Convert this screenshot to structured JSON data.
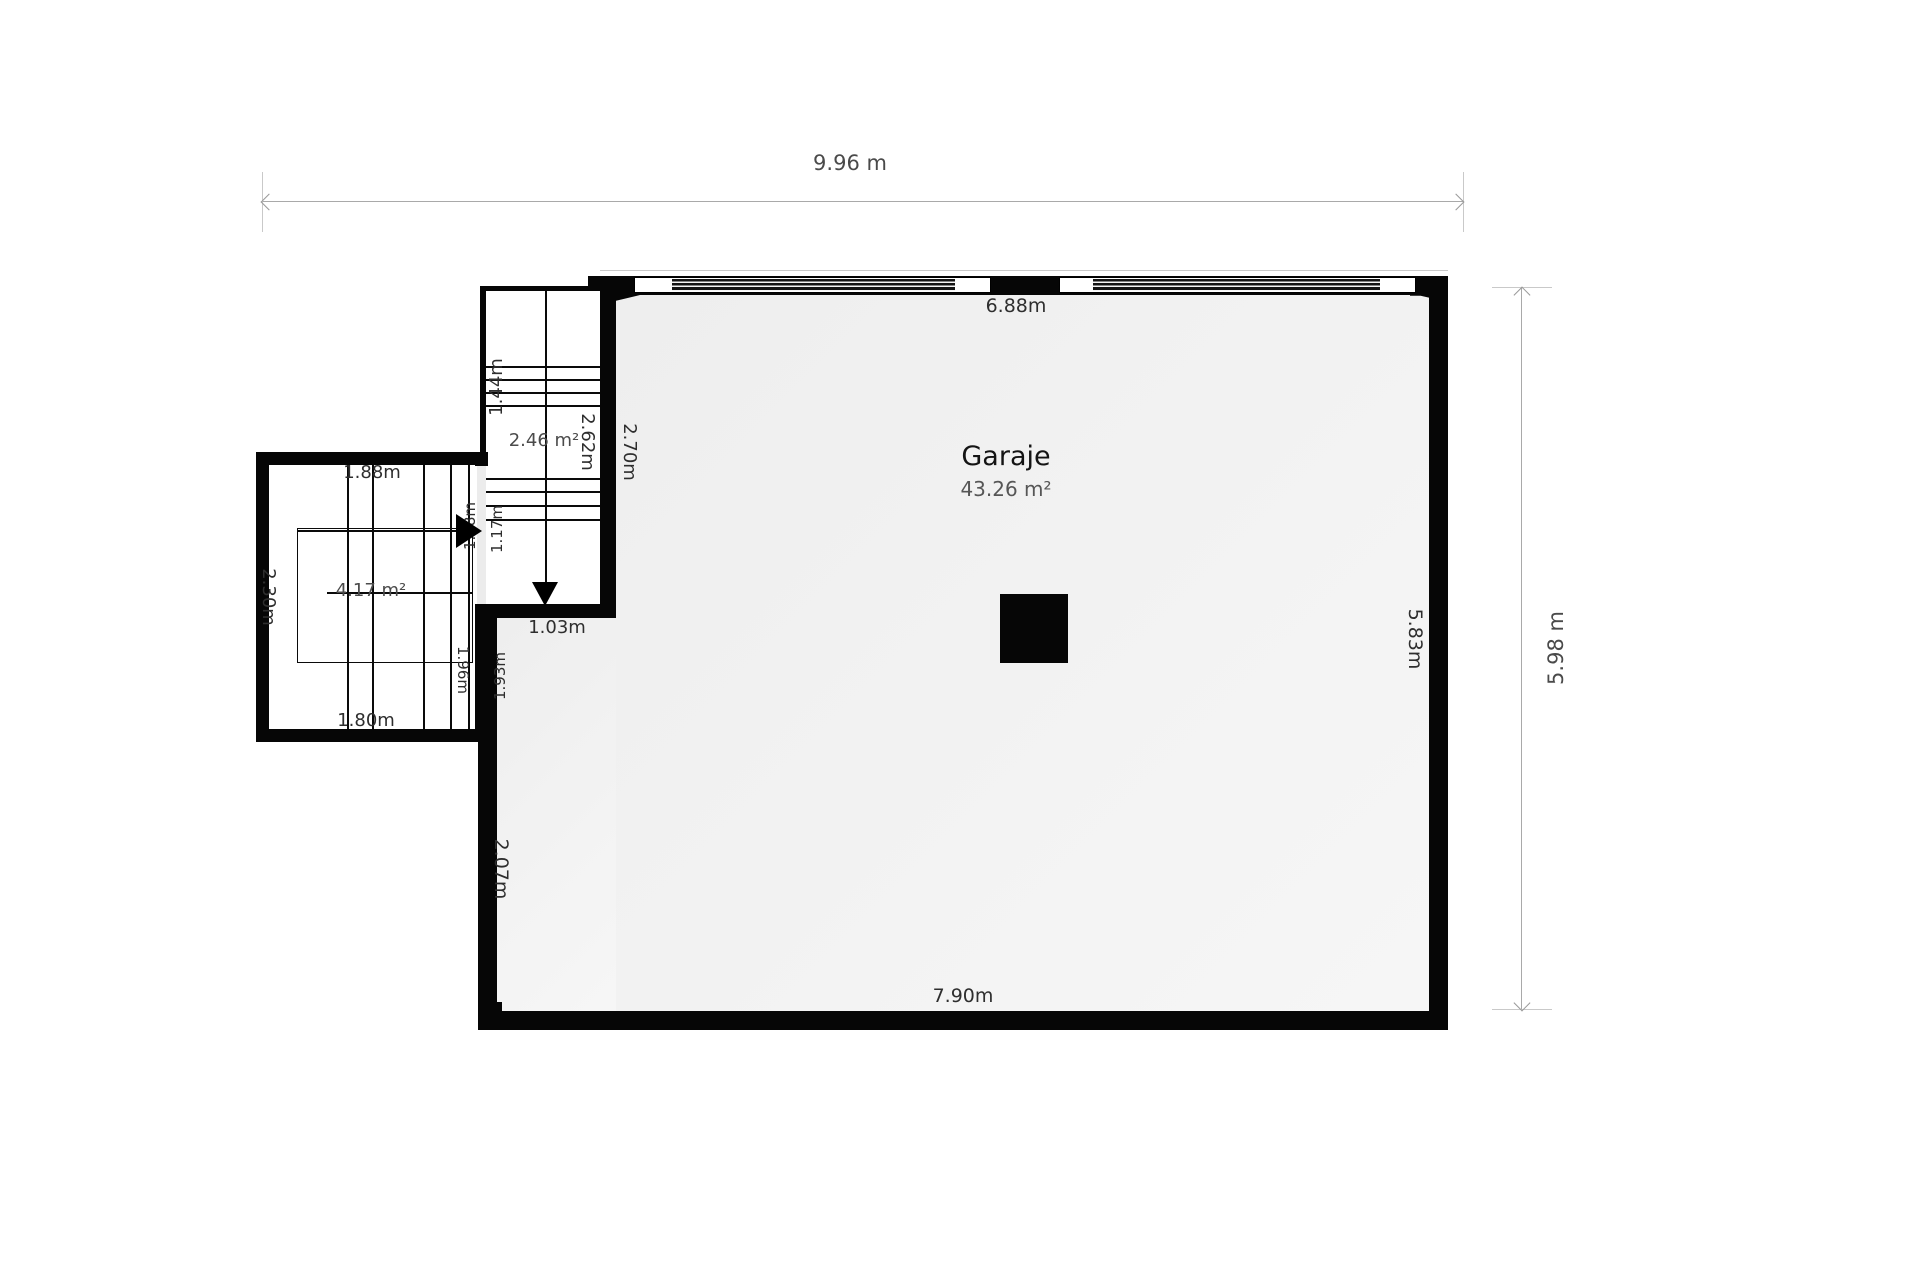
{
  "plan": {
    "overall": {
      "width": "9.96 m",
      "height": "5.98 m"
    },
    "garage": {
      "name": "Garaje",
      "area": "43.26 m²"
    },
    "walls": {
      "window_wall": "6.88m",
      "right": "5.83m",
      "bottom": "7.90m",
      "left_lower": "2.07m",
      "left_upper": "2.70m",
      "opening_below_stairs": "1.03m"
    },
    "upper_stairs": {
      "area": "2.46 m²",
      "width": "2.62m",
      "run_top": "1.44m",
      "run_bottom": "1.17m",
      "landing": "1.18m"
    },
    "lower_stairs": {
      "area": "4.17 m²",
      "top": "1.88m",
      "bottom": "1.80m",
      "left": "2.30m",
      "run_left": "1.96m",
      "run_right": "1.93m"
    },
    "colors": {
      "wall": "#060606",
      "garage_floor": "#f1f1f1",
      "dim_text": "#4a4a4a"
    }
  }
}
